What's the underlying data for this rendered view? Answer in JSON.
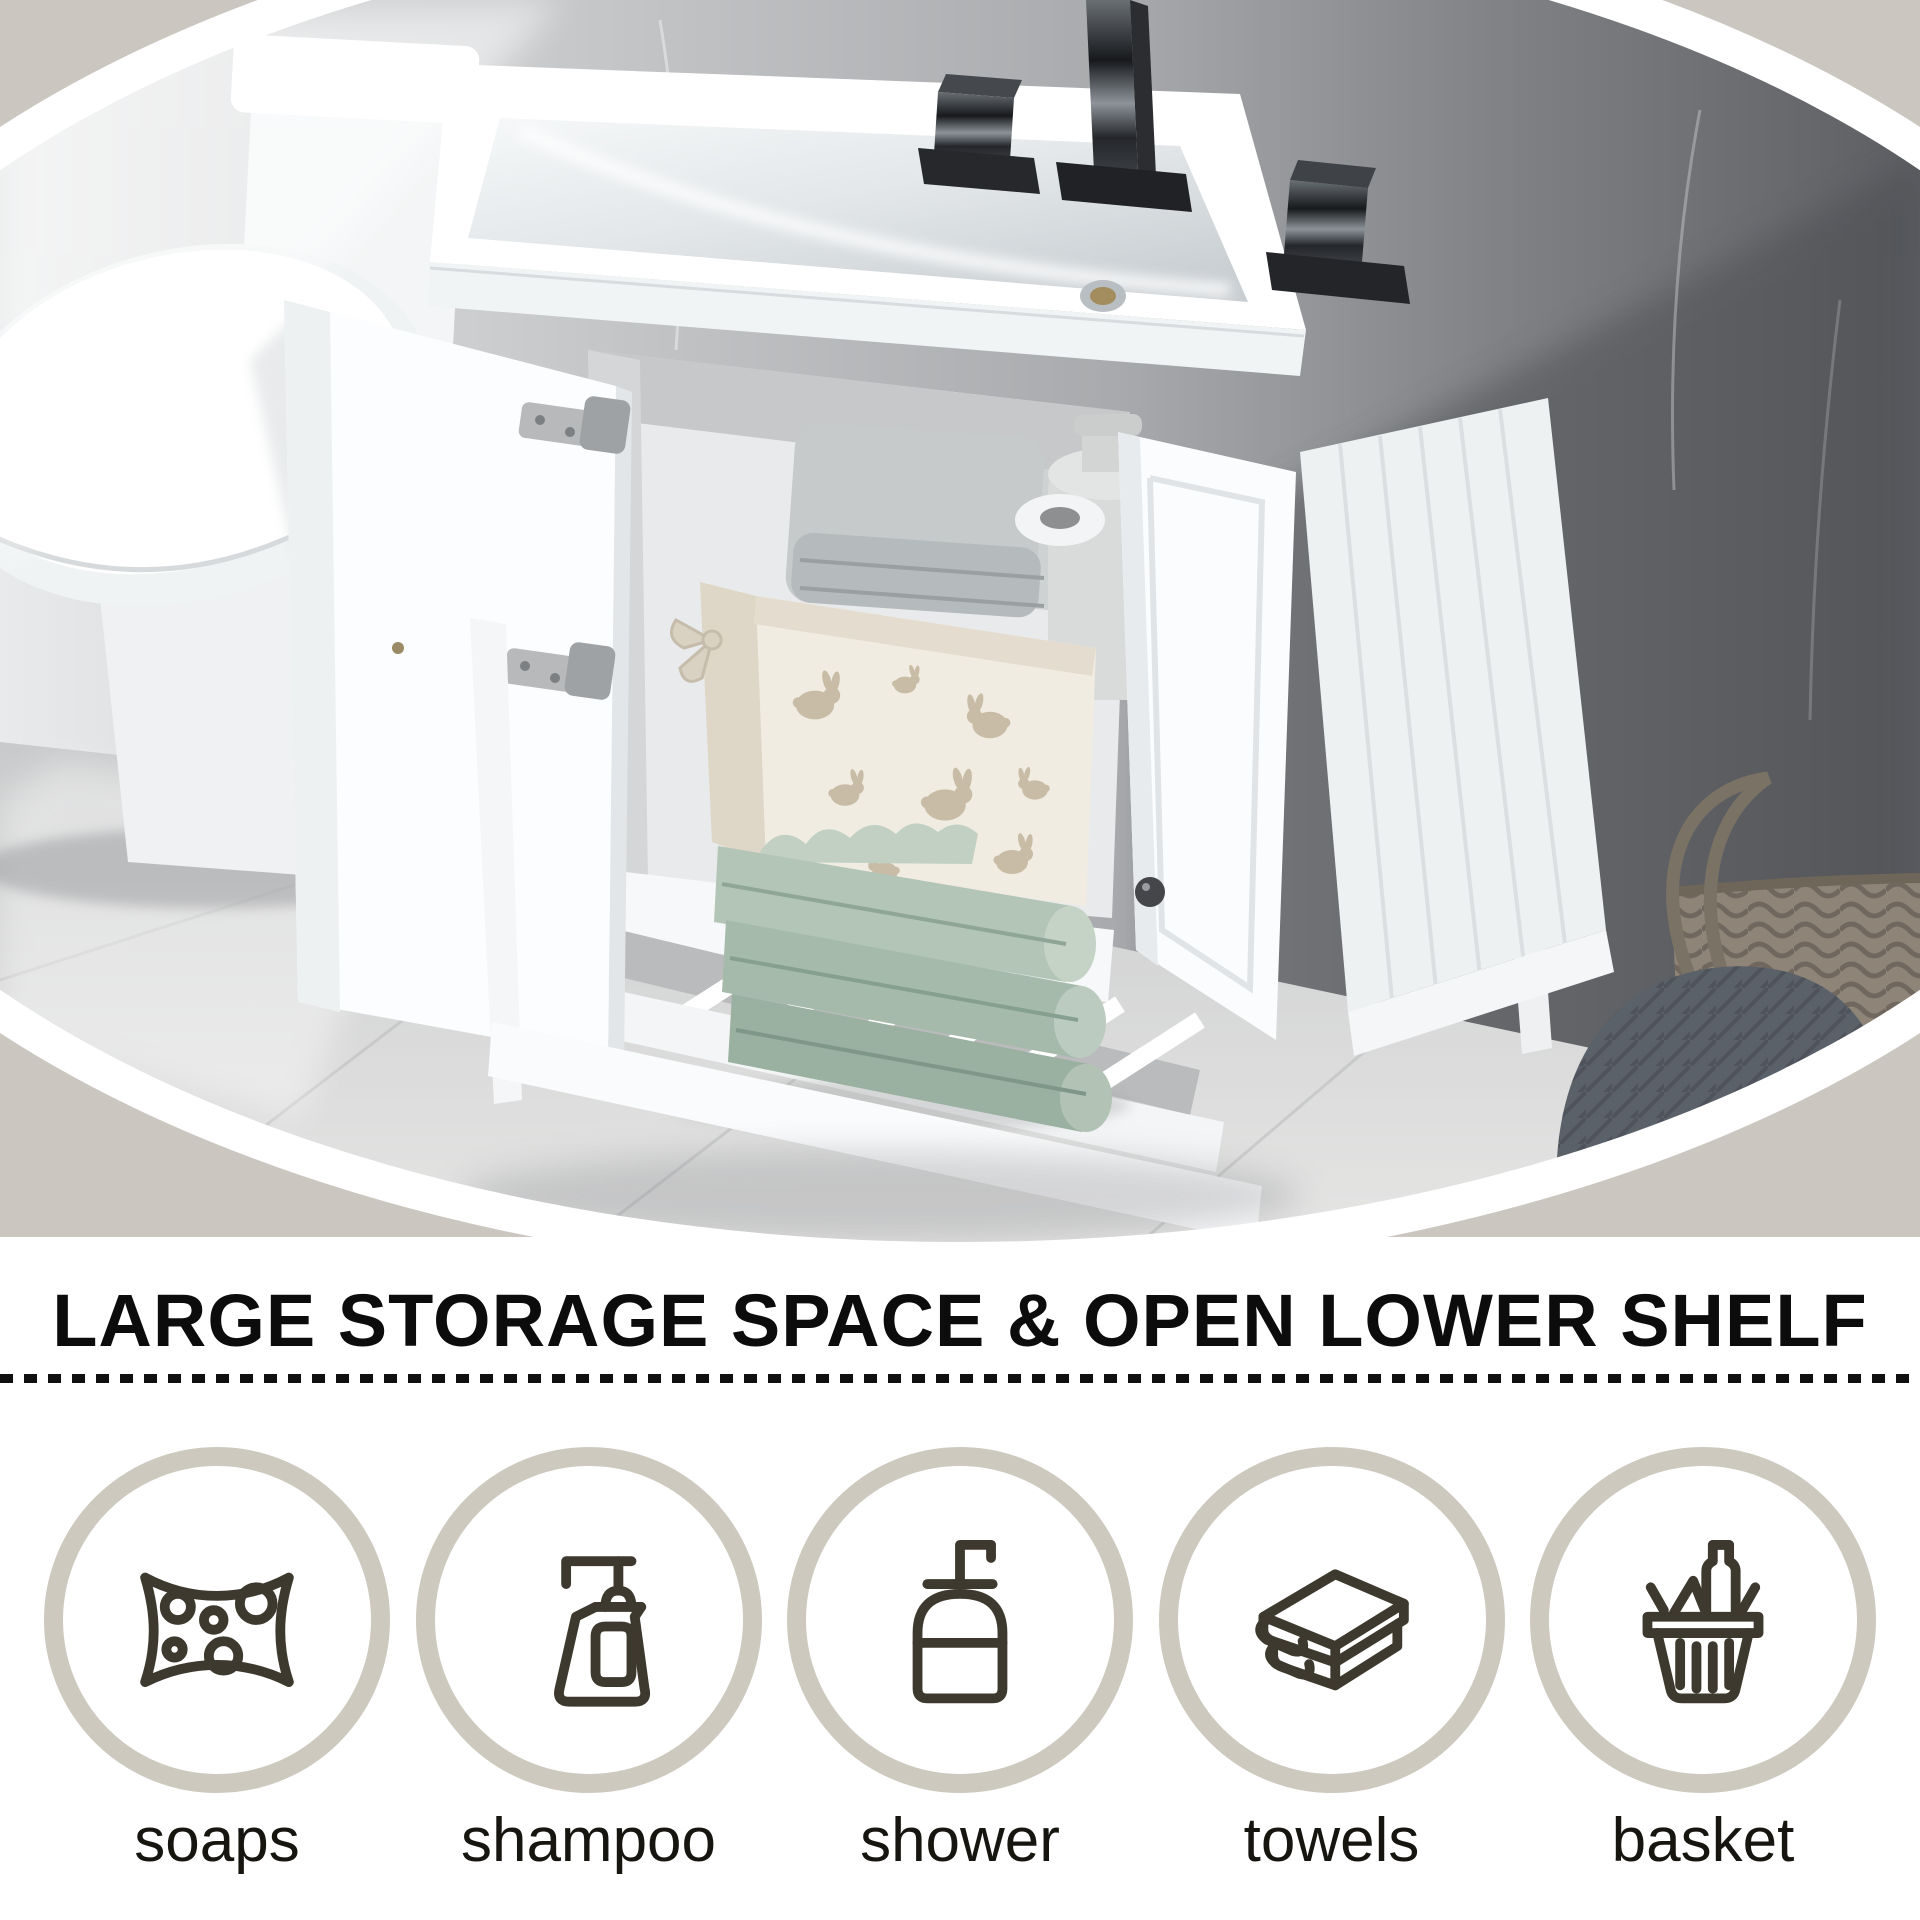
{
  "headline": "LARGE STORAGE SPACE & OPEN LOWER SHELF",
  "features": {
    "items": [
      {
        "icon": "sponge-icon",
        "label": "soaps"
      },
      {
        "icon": "shampoo-pump-icon",
        "label": "shampoo"
      },
      {
        "icon": "shower-gel-icon",
        "label": "shower"
      },
      {
        "icon": "folded-towel-icon",
        "label": "towels"
      },
      {
        "icon": "shopping-basket-icon",
        "label": "basket"
      }
    ]
  },
  "colors": {
    "background_beige": "#cbc7c0",
    "circle_ring": "#cdc9bf",
    "icon_stroke": "#3e392e",
    "headline_text": "#0c0c0c",
    "label_text": "#17150f",
    "divider": "#101010",
    "towel_green": "#a9bcae",
    "dark_wall": "#5c5e62"
  }
}
